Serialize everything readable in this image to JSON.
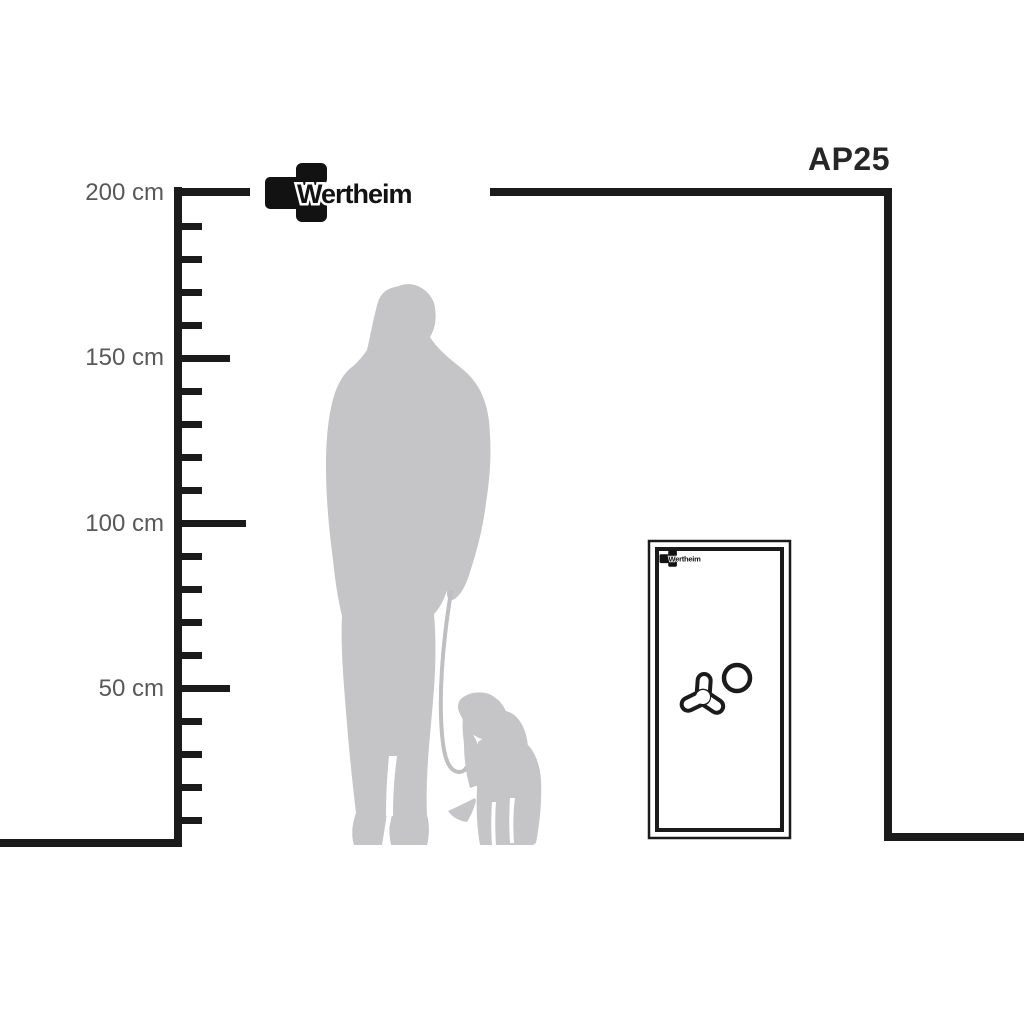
{
  "page": {
    "background": "#ffffff"
  },
  "brand": {
    "name": "Wertheim"
  },
  "model": {
    "label": "AP25"
  },
  "ruler": {
    "unit": "cm",
    "max_cm": 200,
    "min_cm": 10,
    "tick_step_cm": 10,
    "major_step_cm": 50,
    "labels": [
      {
        "cm": 200,
        "text": "200 cm"
      },
      {
        "cm": 150,
        "text": "150 cm"
      },
      {
        "cm": 100,
        "text": "100 cm"
      },
      {
        "cm": 50,
        "text": "50 cm"
      }
    ]
  },
  "safe": {
    "model": "AP25",
    "brand": "Wertheim",
    "handle_icon": "tri-spoke-handle",
    "dial_icon": "combination-dial"
  },
  "silhouette": {
    "subject": "woman standing with dog on leash",
    "color": "#c5c5c7"
  },
  "colors": {
    "line": "#1b1b1b",
    "label": "#58585a",
    "silhouette": "#c5c5c7",
    "leash": "#bfbfc2",
    "model_text": "#262626"
  }
}
